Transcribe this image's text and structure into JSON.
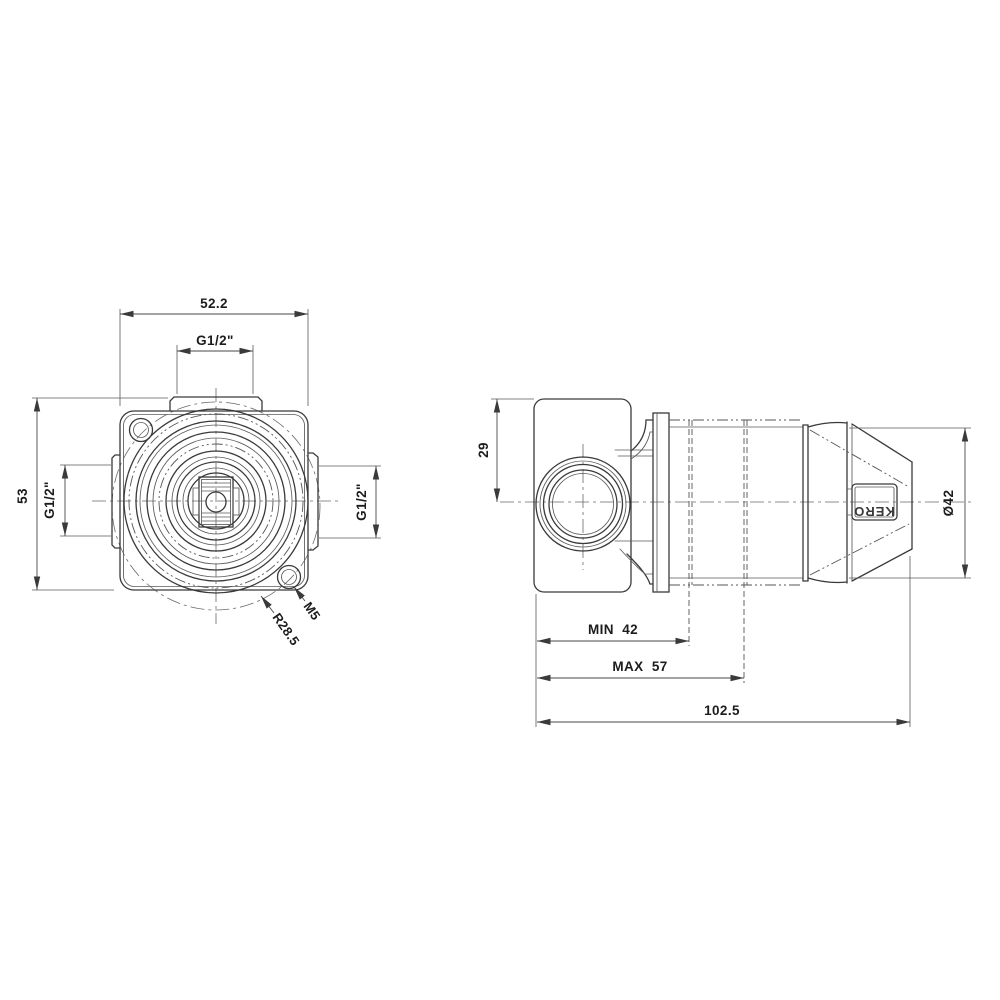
{
  "drawing": {
    "front_view": {
      "width_dim": "52.2",
      "top_port_dim": "G1/2\"",
      "height_dim": "53",
      "left_port_dim": "G1/2\"",
      "right_port_dim": "G1/2\"",
      "flange_radius_dim": "R28.5",
      "screw_hole_dim": "M5"
    },
    "side_view": {
      "port_center_depth_dim": "29",
      "handle_diameter_dim": "Ø42",
      "min_install_depth_dim": "MIN  42",
      "max_install_depth_dim": "MAX  57",
      "overall_length_dim": "102.5",
      "handle_brand_text": "KERO"
    }
  },
  "colors": {
    "line": "#3a3a3a",
    "text": "#1c1c1c",
    "background": "#ffffff"
  }
}
